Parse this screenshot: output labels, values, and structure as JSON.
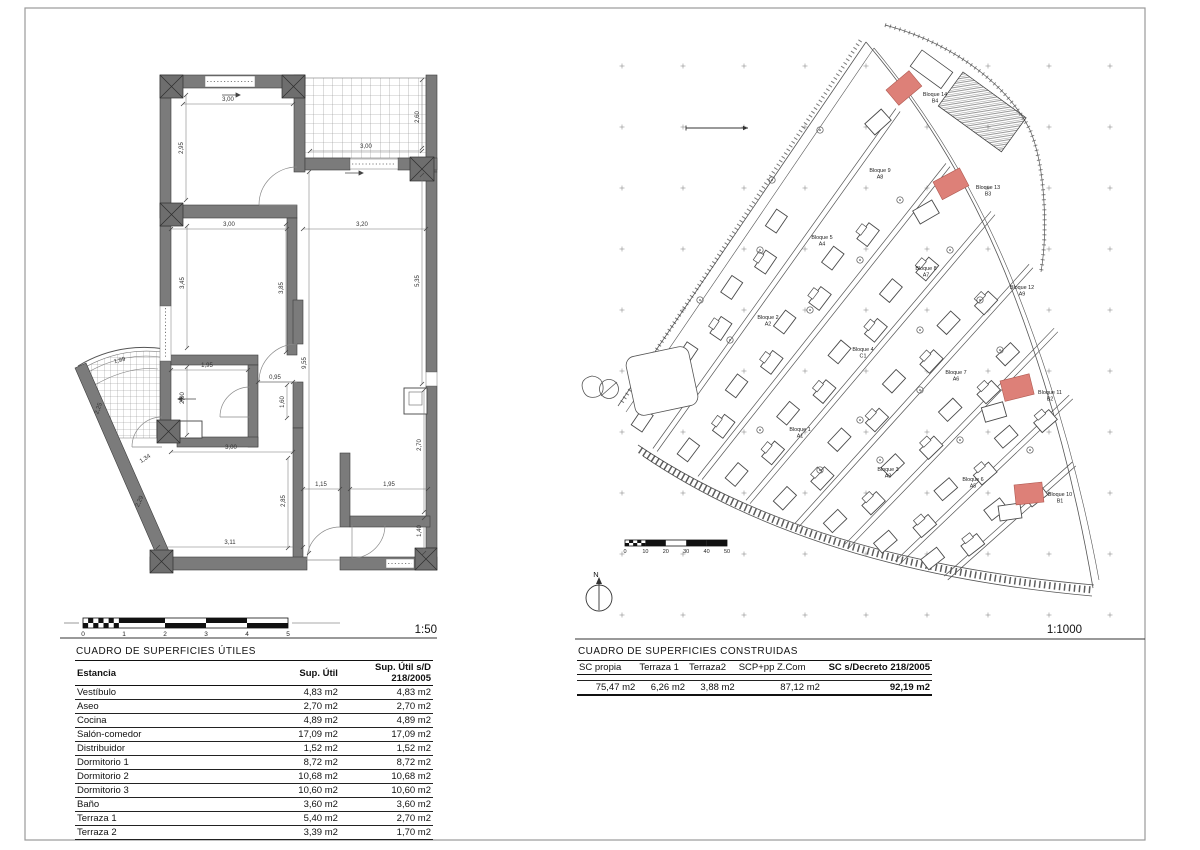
{
  "sheet": {
    "scale_left": "1:50",
    "scale_right": "1:1000"
  },
  "colors": {
    "wall": "#7b7b7b",
    "highlight": "#dd8078",
    "line": "#3c3c3c"
  },
  "floorplan": {
    "scalebar_ticks": [
      "0",
      "1",
      "2",
      "3",
      "4",
      "5"
    ],
    "dims": [
      {
        "t": "3,00",
        "x": 228,
        "y": 101,
        "r": 0,
        "l": [
          183,
          104,
          293,
          104
        ]
      },
      {
        "t": "2,95",
        "x": 183,
        "y": 148,
        "r": -90,
        "l": [
          186,
          95,
          186,
          200
        ]
      },
      {
        "t": "3,00",
        "x": 366,
        "y": 148,
        "r": 0,
        "l": [
          310,
          151,
          422,
          151
        ]
      },
      {
        "t": "2,60",
        "x": 419,
        "y": 117,
        "r": -90,
        "l": [
          422,
          80,
          422,
          148
        ]
      },
      {
        "t": "3,00",
        "x": 229,
        "y": 226,
        "r": 0,
        "l": [
          171,
          229,
          287,
          229
        ]
      },
      {
        "t": "3,20",
        "x": 362,
        "y": 226,
        "r": 0,
        "l": [
          303,
          229,
          426,
          229
        ]
      },
      {
        "t": "3,45",
        "x": 184,
        "y": 283,
        "r": -90,
        "l": [
          187,
          226,
          187,
          348
        ]
      },
      {
        "t": "3,85",
        "x": 283,
        "y": 288,
        "r": -90,
        "l": [
          286,
          224,
          286,
          352
        ]
      },
      {
        "t": "5,35",
        "x": 419,
        "y": 281,
        "r": -90,
        "l": [
          422,
          175,
          422,
          384
        ]
      },
      {
        "t": "9,55",
        "x": 306,
        "y": 363,
        "r": -90,
        "l": [
          309,
          172,
          309,
          553
        ]
      },
      {
        "t": "1,95",
        "x": 207,
        "y": 367,
        "r": 0,
        "l": [
          171,
          370,
          248,
          370
        ]
      },
      {
        "t": "0,95",
        "x": 275,
        "y": 379,
        "r": 0,
        "l": [
          258,
          382,
          293,
          382
        ]
      },
      {
        "t": "2,00",
        "x": 184,
        "y": 398,
        "r": -90,
        "l": [
          187,
          367,
          187,
          435
        ]
      },
      {
        "t": "1,60",
        "x": 284,
        "y": 402,
        "r": -90,
        "l": [
          287,
          385,
          287,
          418
        ]
      },
      {
        "t": "1,99",
        "x": 120,
        "y": 362,
        "r": -14,
        "l": null
      },
      {
        "t": "2,25",
        "x": 100,
        "y": 409,
        "r": -70,
        "l": null
      },
      {
        "t": "1,34",
        "x": 146,
        "y": 460,
        "r": -33,
        "l": null
      },
      {
        "t": "2,29",
        "x": 141,
        "y": 502,
        "r": -66,
        "l": null
      },
      {
        "t": "3,00",
        "x": 231,
        "y": 449,
        "r": 0,
        "l": [
          171,
          452,
          293,
          452
        ]
      },
      {
        "t": "2,85",
        "x": 285,
        "y": 501,
        "r": -90,
        "l": [
          288,
          458,
          288,
          548
        ]
      },
      {
        "t": "1,15",
        "x": 321,
        "y": 486,
        "r": 0,
        "l": [
          303,
          489,
          340,
          489
        ]
      },
      {
        "t": "1,95",
        "x": 389,
        "y": 486,
        "r": 0,
        "l": [
          350,
          489,
          428,
          489
        ]
      },
      {
        "t": "2,70",
        "x": 421,
        "y": 445,
        "r": -90,
        "l": [
          424,
          390,
          424,
          512
        ]
      },
      {
        "t": "1,40",
        "x": 421,
        "y": 531,
        "r": -90,
        "l": [
          424,
          518,
          424,
          553
        ]
      },
      {
        "t": "3,11",
        "x": 230,
        "y": 544,
        "r": 0,
        "l": [
          158,
          547,
          303,
          547
        ]
      }
    ]
  },
  "siteplan": {
    "north": "N",
    "scalebar_ticks": [
      "0",
      "10",
      "20",
      "30",
      "40",
      "50"
    ],
    "bloques": [
      {
        "name": "Bloque 1",
        "code": "A1",
        "x": 800,
        "y": 431
      },
      {
        "name": "Bloque 2",
        "code": "A2",
        "x": 768,
        "y": 319
      },
      {
        "name": "Bloque 3",
        "code": "A3",
        "x": 888,
        "y": 471
      },
      {
        "name": "Bloque 4",
        "code": "C1",
        "x": 863,
        "y": 351
      },
      {
        "name": "Bloque 5",
        "code": "A4",
        "x": 822,
        "y": 239
      },
      {
        "name": "Bloque 6",
        "code": "A5",
        "x": 973,
        "y": 481
      },
      {
        "name": "Bloque 7",
        "code": "A6",
        "x": 956,
        "y": 374
      },
      {
        "name": "Bloque 8",
        "code": "A7",
        "x": 926,
        "y": 270
      },
      {
        "name": "Bloque 9",
        "code": "A8",
        "x": 880,
        "y": 172
      },
      {
        "name": "Bloque 10",
        "code": "B1",
        "x": 1060,
        "y": 496
      },
      {
        "name": "Bloque 11",
        "code": "B2",
        "x": 1050,
        "y": 394
      },
      {
        "name": "Bloque 12",
        "code": "A9",
        "x": 1022,
        "y": 289
      },
      {
        "name": "Bloque 13",
        "code": "B3",
        "x": 988,
        "y": 189
      },
      {
        "name": "Bloque 14",
        "code": "B4",
        "x": 935,
        "y": 96
      }
    ],
    "highlights": [
      {
        "x": 886,
        "y": 90,
        "w": 30,
        "h": 20,
        "rot": -40
      },
      {
        "x": 933,
        "y": 182,
        "w": 30,
        "h": 20,
        "rot": -28
      },
      {
        "x": 1000,
        "y": 381,
        "w": 30,
        "h": 21,
        "rot": -14
      },
      {
        "x": 1014,
        "y": 485,
        "w": 28,
        "h": 20,
        "rot": -6
      }
    ]
  },
  "tables": {
    "utiles": {
      "title": "CUADRO DE SUPERFICIES ÚTILES",
      "headers": [
        "Estancia",
        "Sup. Útil",
        "Sup. Útil s/D 218/2005"
      ],
      "rows": [
        [
          "Vestíbulo",
          "4,83 m2",
          "4,83 m2"
        ],
        [
          "Aseo",
          "2,70 m2",
          "2,70 m2"
        ],
        [
          "Cocina",
          "4,89 m2",
          "4,89 m2"
        ],
        [
          "Salón-comedor",
          "17,09 m2",
          "17,09 m2"
        ],
        [
          "Distribuidor",
          "1,52 m2",
          "1,52 m2"
        ],
        [
          "Dormitorio 1",
          "8,72 m2",
          "8,72 m2"
        ],
        [
          "Dormitorio 2",
          "10,68 m2",
          "10,68 m2"
        ],
        [
          "Dormitorio 3",
          "10,60 m2",
          "10,60 m2"
        ],
        [
          "Baño",
          "3,60 m2",
          "3,60 m2"
        ],
        [
          "Terraza 1",
          "5,40 m2",
          "2,70 m2"
        ],
        [
          "Terraza 2",
          "3,39 m2",
          "1,70 m2"
        ]
      ]
    },
    "construidas": {
      "title": "CUADRO DE SUPERFICIES CONSTRUIDAS",
      "headers": [
        "SC propia",
        "Terraza 1",
        "Terraza2",
        "SCP+pp Z.Com",
        "SC s/Decreto 218/2005"
      ],
      "values": [
        "75,47 m2",
        "6,26 m2",
        "3,88 m2",
        "87,12 m2",
        "92,19 m2"
      ]
    }
  }
}
